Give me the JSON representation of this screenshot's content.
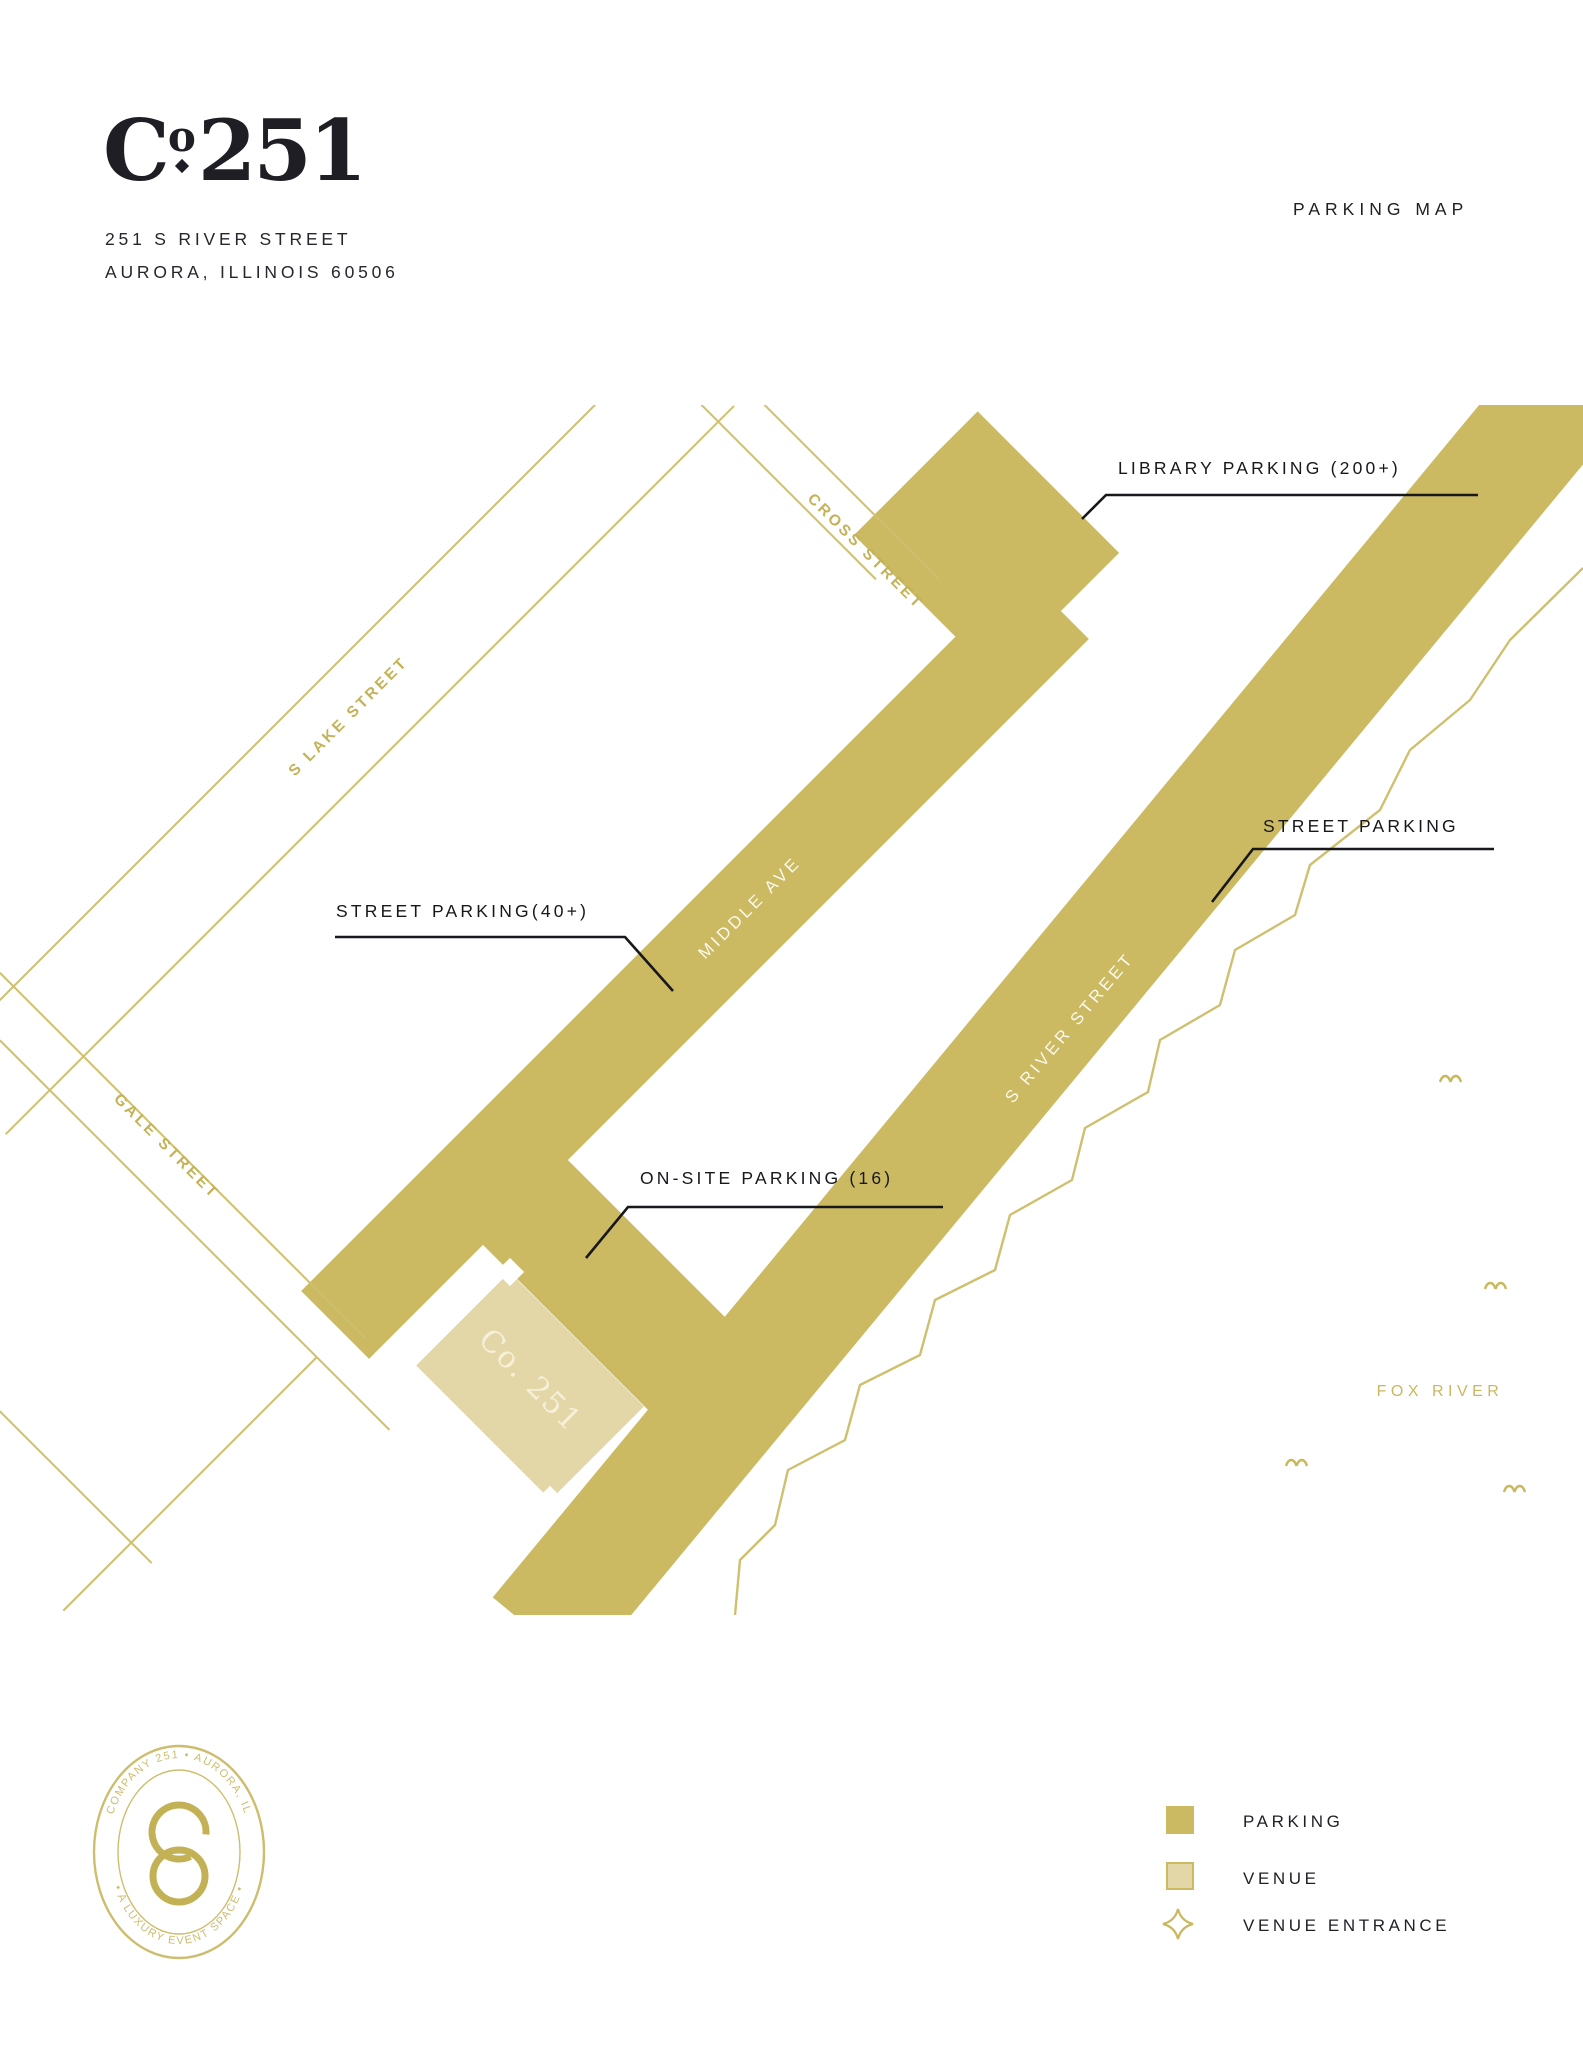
{
  "header": {
    "logo_c": "C",
    "logo_o": "o",
    "logo_number": "251",
    "address_line1": "251 S RIVER STREET",
    "address_line2": "AURORA, ILLINOIS 60506",
    "map_title": "PARKING MAP"
  },
  "map": {
    "annotations": {
      "library": "LIBRARY PARKING (200+)",
      "street_parking_right": "STREET PARKING",
      "street_parking_left": "STREET PARKING(40+)",
      "onsite": "ON-SITE PARKING (16)"
    },
    "streets": {
      "cross": "CROSS STREET",
      "s_lake": "S LAKE STREET",
      "gale": "GALE STREET",
      "middle": "MIDDLE AVE",
      "s_river": "S RIVER STREET"
    },
    "venue_label": "Co. 251",
    "river_label": "FOX RIVER"
  },
  "legend": {
    "parking": "PARKING",
    "venue": "VENUE",
    "venue_entrance": "VENUE ENTRANCE"
  },
  "seal": {
    "top_text": "COMPANY 251 • AURORA, IL",
    "bottom_text": "• A LUXURY EVENT SPACE •"
  },
  "colors": {
    "gold": "#cbba62",
    "venue_tan": "#e3d7a7",
    "ink": "#1f1f26",
    "white": "#ffffff"
  }
}
